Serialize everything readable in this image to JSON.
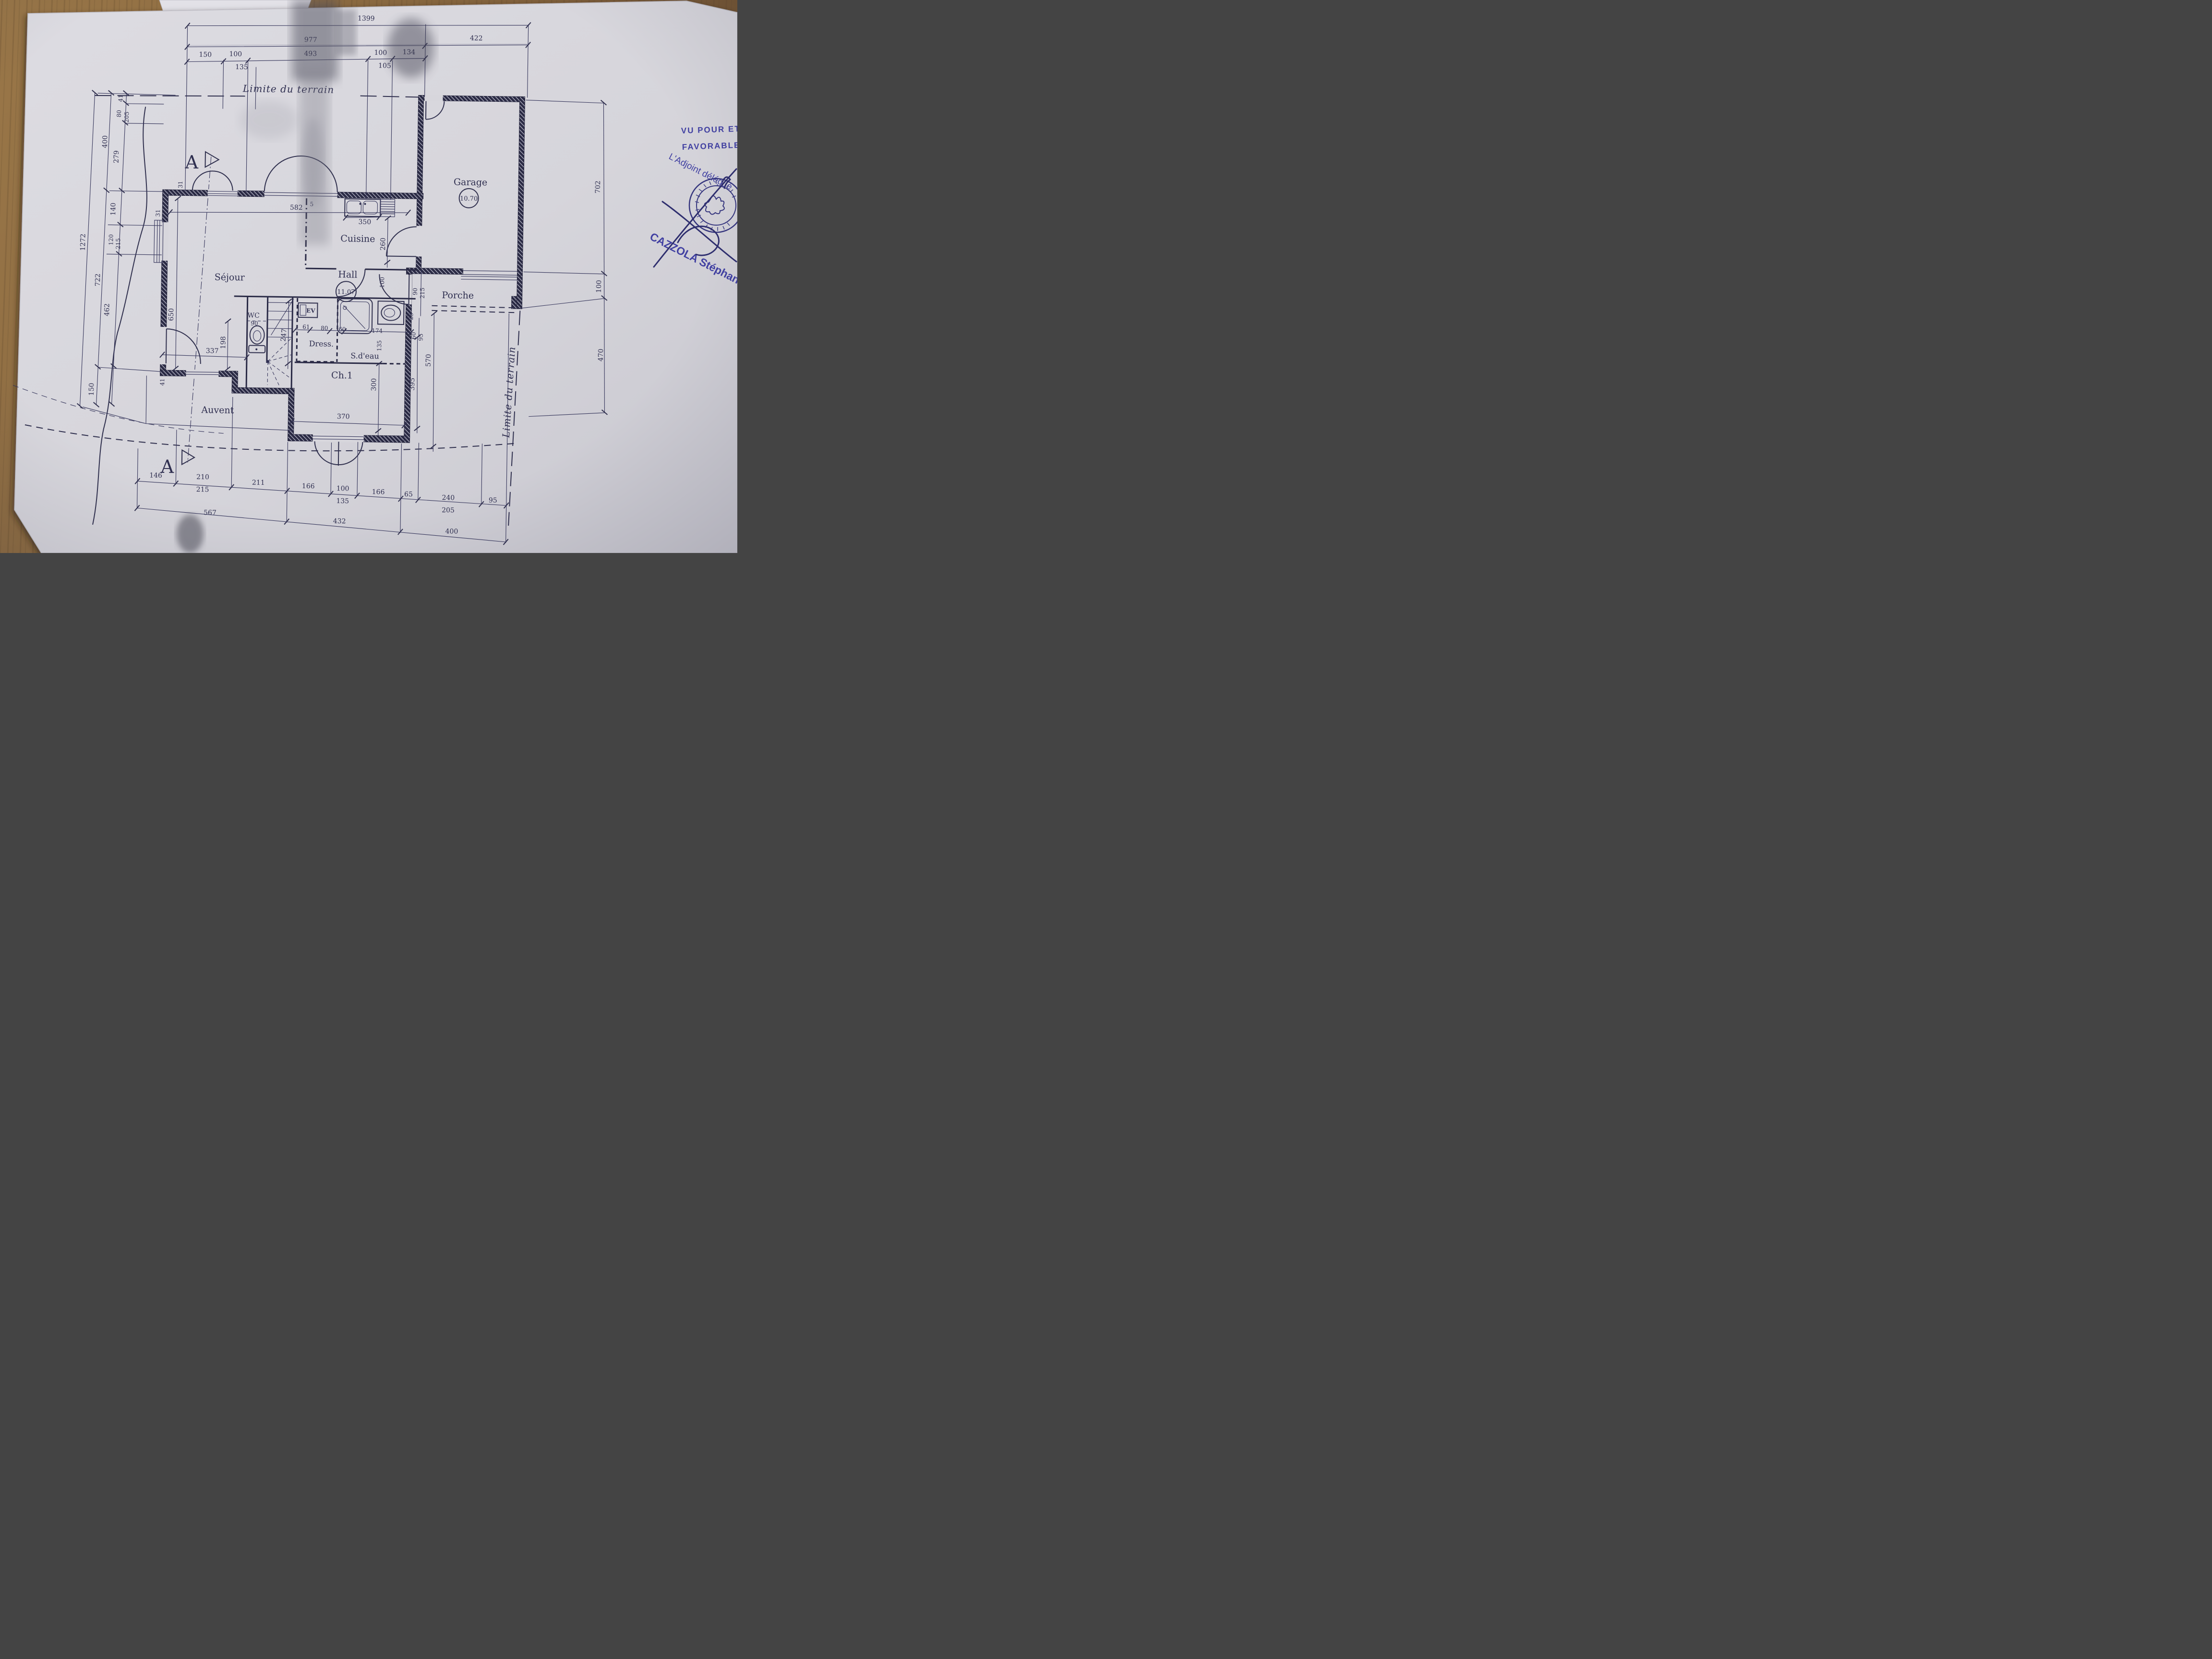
{
  "colors": {
    "ink": "#2f2f50",
    "stamp_blue": "#4140a2",
    "paper": "#d7d6dc",
    "wood": "#8f6c44"
  },
  "plan": {
    "rooms": {
      "garage": {
        "label": "Garage",
        "area": "10.70"
      },
      "cuisine": {
        "label": "Cuisine"
      },
      "sejour": {
        "label": "Séjour"
      },
      "hall": {
        "label": "Hall",
        "area": "11.07"
      },
      "porche": {
        "label": "Porche"
      },
      "wc": {
        "label": "WC"
      },
      "dress": {
        "label": "Dress."
      },
      "sdeau": {
        "label": "S.d'eau"
      },
      "ch1": {
        "label": "Ch.1"
      },
      "auvent": {
        "label": "Auvent"
      },
      "ev": {
        "label": "EV"
      }
    },
    "dims_top": {
      "total": "1399",
      "left_total": "977",
      "right_total": "422",
      "s150": "150",
      "s100a": "100",
      "s135": "135",
      "s493": "493",
      "s100b": "100",
      "s105": "105",
      "s134": "134"
    },
    "dims_left": {
      "total": "1272",
      "m400": "400",
      "m722": "722",
      "m150": "150",
      "s41": "41",
      "s80": "80",
      "s205": "205",
      "s279": "279",
      "s140": "140",
      "s120": "120",
      "s215": "215",
      "s462": "462"
    },
    "dims_right": {
      "s702": "702",
      "s100": "100",
      "s470": "470"
    },
    "dims_bottom": {
      "s146": "146",
      "s210": "210",
      "s215": "215",
      "s211": "211",
      "s166a": "166",
      "s100": "100",
      "s135": "135",
      "s166b": "166",
      "s65": "65",
      "s240": "240",
      "s205": "205",
      "s95": "95",
      "t567": "567",
      "t432": "432",
      "t400": "400"
    },
    "dims_interior": {
      "d582": "582",
      "d31a": "31",
      "d31b": "31",
      "d650": "650",
      "d5": "5",
      "d350": "350",
      "d260": "260",
      "d198": "198",
      "d337": "337",
      "d247": "247",
      "d90wc": "90",
      "d41": "41",
      "d61": "61",
      "d80": "80",
      "d60": "60",
      "d174": "174",
      "d135": "135",
      "d100door": "100",
      "d90": "90",
      "d215": "215",
      "d25": "25",
      "d60b": "60",
      "d95": "95",
      "d570": "570",
      "d395": "395",
      "d300": "300",
      "d370": "370"
    }
  },
  "annotations": {
    "limite_top": "Limite du terrain",
    "limite_right": "Limite du terrain",
    "section_a_top": "A",
    "section_a_bottom": "A"
  },
  "stamp": {
    "line1": "VU POUR ET",
    "line2": "FAVORABLE",
    "title": "L'Adjoint délégué",
    "name": "CAZZOLA Stéphane"
  }
}
